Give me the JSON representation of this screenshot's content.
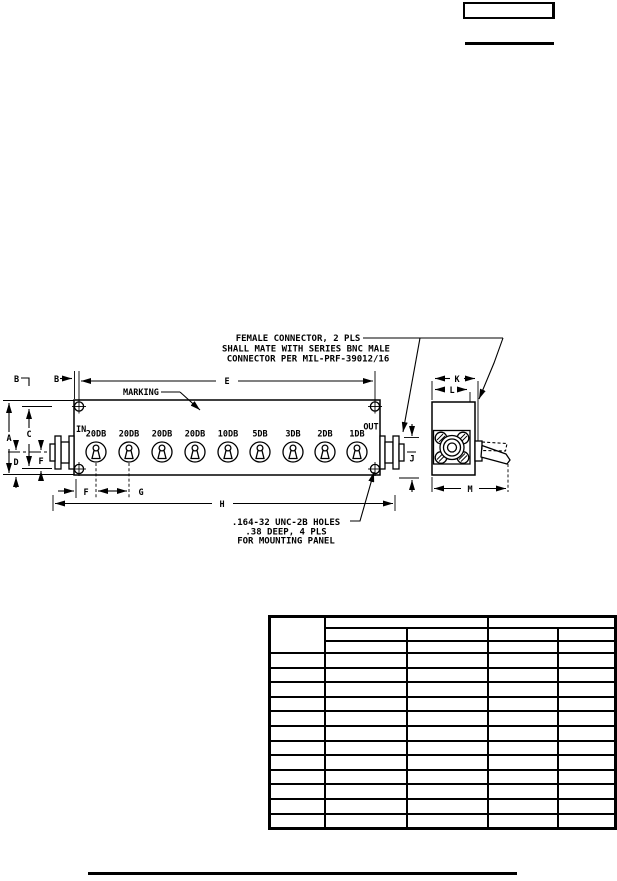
{
  "figure": {
    "connector_note": [
      "FEMALE CONNECTOR, 2 PLS",
      "SHALL MATE WITH SERIES BNC MALE",
      "CONNECTOR PER MIL-PRF-39012/16"
    ],
    "marking_label": "MARKING",
    "in_label": "IN",
    "out_label": "OUT",
    "switch_labels": [
      "20DB",
      "20DB",
      "20DB",
      "20DB",
      "10DB",
      "5DB",
      "3DB",
      "2DB",
      "1DB"
    ],
    "dim_labels": {
      "A": "A",
      "B": "B",
      "C": "C",
      "D": "D",
      "E": "E",
      "F": "F",
      "G": "G",
      "H": "H",
      "J": "J",
      "K": "K",
      "L": "L",
      "M": "M"
    },
    "holes_note": [
      ".164-32 UNC-2B HOLES",
      ".38 DEEP, 4 PLS",
      "FOR MOUNTING PANEL"
    ]
  },
  "table": {
    "column_count": 5,
    "header_row_count": 3,
    "body_row_count": 12,
    "cells_blank": true
  }
}
